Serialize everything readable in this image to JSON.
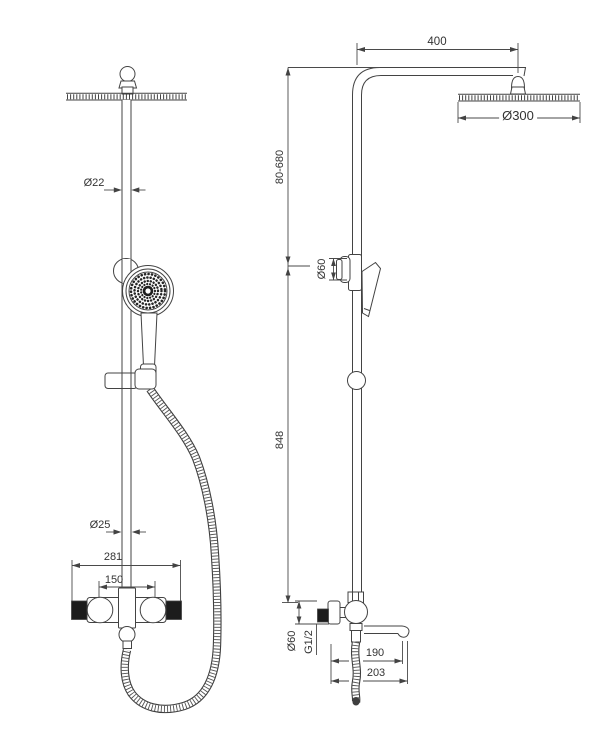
{
  "drawing": {
    "type": "technical-dimension-drawing",
    "subject": "thermostatic shower column with rain head and hand shower",
    "line_color": "#434343",
    "background": "#ffffff"
  },
  "labels": {
    "front": {
      "pipe_diameter": "Ø22",
      "lower_pipe_diameter": "Ø25",
      "mixer_width": "281",
      "inlet_spacing": "150"
    },
    "side": {
      "arm_reach": "400",
      "head_diameter": "Ø300",
      "holder_range": "80-680",
      "handshower_head_diameter": "Ø60",
      "rail_height": "848",
      "knob_diameter": "Ø60",
      "thread": "G1/2",
      "spout_reach": "190",
      "spout_total": "203"
    }
  }
}
